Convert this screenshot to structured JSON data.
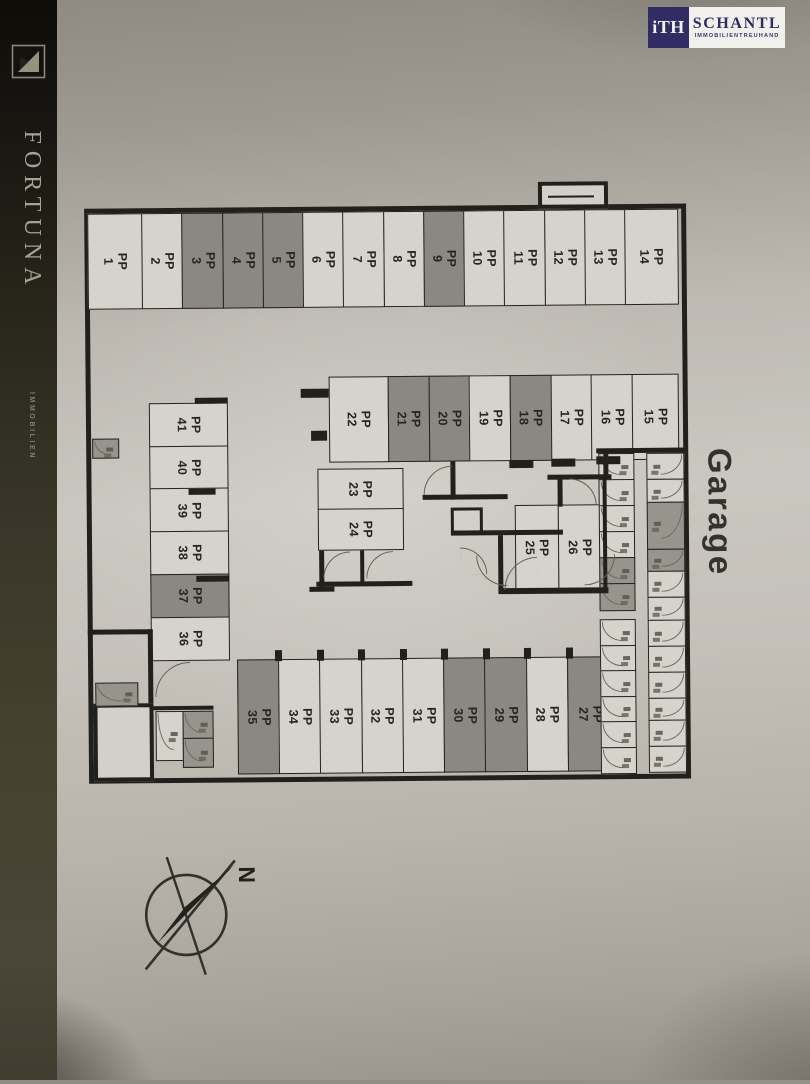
{
  "branding": {
    "fortuna": {
      "name": "FORTUNA",
      "subtitle": "IMMOBILIEN",
      "icon": "fortuna-triangle-logo"
    },
    "schantl": {
      "monogram": "iTH",
      "name": "SCHANTL",
      "subtitle": "IMMOBILIENTREUHAND",
      "navy": "#312c63"
    }
  },
  "plan": {
    "area_label": "Garage",
    "compass_label": "N",
    "spot_prefix": "PP",
    "colors": {
      "wall": "#21201c",
      "spot_white": "#d6d3cc",
      "spot_gray": "#8a8881",
      "paper": "#c5c1ba"
    },
    "rows": {
      "top": [
        {
          "n": "1",
          "shade": "white"
        },
        {
          "n": "2",
          "shade": "white"
        },
        {
          "n": "3",
          "shade": "gray"
        },
        {
          "n": "4",
          "shade": "gray"
        },
        {
          "n": "5",
          "shade": "gray"
        },
        {
          "n": "6",
          "shade": "white"
        },
        {
          "n": "7",
          "shade": "white"
        },
        {
          "n": "8",
          "shade": "white"
        },
        {
          "n": "9",
          "shade": "gray"
        },
        {
          "n": "10",
          "shade": "white"
        },
        {
          "n": "11",
          "shade": "white"
        },
        {
          "n": "12",
          "shade": "white"
        },
        {
          "n": "13",
          "shade": "white"
        },
        {
          "n": "14",
          "shade": "white"
        }
      ],
      "middle": [
        {
          "n": "22",
          "shade": "white"
        },
        {
          "n": "21",
          "shade": "gray"
        },
        {
          "n": "20",
          "shade": "gray"
        },
        {
          "n": "19",
          "shade": "white"
        },
        {
          "n": "18",
          "shade": "gray"
        },
        {
          "n": "17",
          "shade": "white"
        },
        {
          "n": "16",
          "shade": "white"
        },
        {
          "n": "15",
          "shade": "white"
        }
      ],
      "left_column": [
        {
          "n": "41",
          "shade": "white"
        },
        {
          "n": "40",
          "shade": "white"
        },
        {
          "n": "39",
          "shade": "white"
        },
        {
          "n": "38",
          "shade": "white"
        },
        {
          "n": "37",
          "shade": "gray"
        },
        {
          "n": "36",
          "shade": "white"
        }
      ],
      "block_23_24": [
        {
          "n": "23",
          "shade": "white"
        },
        {
          "n": "24",
          "shade": "white"
        }
      ],
      "block_25_26": [
        {
          "n": "25",
          "shade": "white"
        },
        {
          "n": "26",
          "shade": "white"
        }
      ],
      "bottom": [
        {
          "n": "35",
          "shade": "gray"
        },
        {
          "n": "34",
          "shade": "white"
        },
        {
          "n": "33",
          "shade": "white"
        },
        {
          "n": "32",
          "shade": "white"
        },
        {
          "n": "31",
          "shade": "white"
        },
        {
          "n": "30",
          "shade": "gray"
        },
        {
          "n": "29",
          "shade": "gray"
        },
        {
          "n": "28",
          "shade": "white"
        },
        {
          "n": "27",
          "shade": "gray"
        }
      ]
    },
    "storage": {
      "left_column_upper": [
        {
          "shade": "white"
        },
        {
          "shade": "white"
        },
        {
          "shade": "white"
        },
        {
          "shade": "white"
        },
        {
          "shade": "gray"
        },
        {
          "shade": "gray"
        }
      ],
      "left_column_lower": [
        {
          "shade": "white"
        },
        {
          "shade": "white"
        },
        {
          "shade": "white"
        },
        {
          "shade": "white"
        },
        {
          "shade": "white"
        },
        {
          "shade": "white"
        }
      ],
      "right_column": [
        {
          "shade": "white",
          "h": 1
        },
        {
          "shade": "white",
          "h": 0.9
        },
        {
          "shade": "gray",
          "h": 1.8
        },
        {
          "shade": "gray",
          "h": 0.85
        },
        {
          "shade": "white",
          "h": 1
        },
        {
          "shade": "white",
          "h": 0.9
        },
        {
          "shade": "white",
          "h": 1
        },
        {
          "shade": "white",
          "h": 1
        },
        {
          "shade": "white",
          "h": 1
        },
        {
          "shade": "white",
          "h": 0.85
        },
        {
          "shade": "white",
          "h": 1
        },
        {
          "shade": "white",
          "h": 1
        }
      ]
    }
  }
}
